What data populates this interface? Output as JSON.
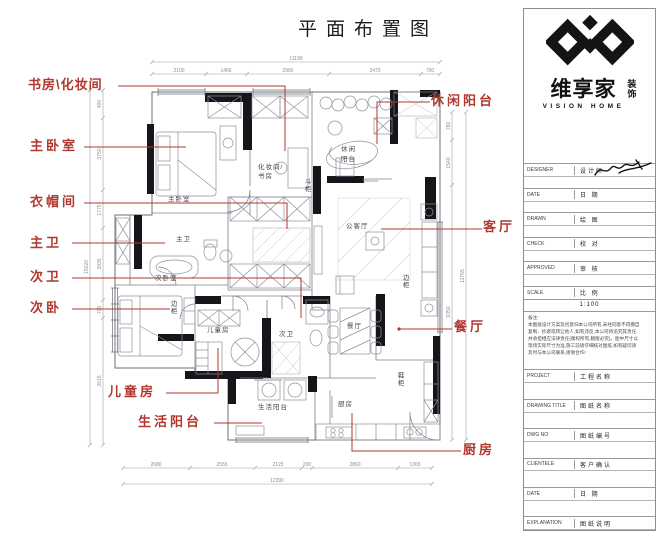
{
  "title": "平面布置图",
  "annotations": {
    "left": [
      "书房\\化妆间",
      "主卧室",
      "衣帽间",
      "主卫",
      "次卫",
      "次卧",
      "儿童房",
      "生活阳台"
    ],
    "right": [
      "休闲阳台",
      "客厅",
      "餐厅",
      "厨房"
    ]
  },
  "rooms": {
    "master_bedroom": "主卧室",
    "study_line1": "化妆间/",
    "study_line2": "书房",
    "chest": "斗柜",
    "leisure_line1": "休闲",
    "leisure_line2": "阳台",
    "living": "公客厅",
    "master_bath": "主卫",
    "second_bedroom": "次卧室",
    "side_cabinet_bedroom": "边柜",
    "kids_room": "儿童房",
    "second_bath": "次卫",
    "laundry_balcony": "生活阳台",
    "dining": "餐厅",
    "shoe_cabinet": "鞋柜",
    "kitchen": "厨房",
    "side_cabinet_living": "边柜"
  },
  "dims": {
    "top": {
      "total": "11190",
      "segments": [
        "2100",
        "1466",
        "2965",
        "3470",
        "700"
      ]
    },
    "bottom": {
      "total": "12390",
      "segments": [
        "2680",
        "2555",
        "2125",
        "200",
        "2860",
        "1365"
      ]
    },
    "left": {
      "total": "15020",
      "segments": [
        "400",
        "3750",
        "1775",
        "3935",
        "705",
        "2615"
      ]
    },
    "right": {
      "total": "11755",
      "segments": [
        "780",
        "1540",
        "9350"
      ]
    }
  },
  "brand": {
    "name_cn": "维享家",
    "suffix_char1": "装",
    "suffix_char2": "饰",
    "name_en": "VISION HOME"
  },
  "titleblock": {
    "scale_value": "1:100",
    "notes_title": "备注:",
    "notes_lines": [
      "本图纸设计方案及创意归本公司所有,未经同意不得擅自",
      "复制、抄袭或转让他人,如有违反,本公司将追究其责任,",
      "并承担相应法律责任(版权所有,翻版必究)。图中尺寸以",
      "现场实际尺寸为准,施工前请仔细核对图纸,如有疑问请",
      "及时与本公司联系,谢谢合作!"
    ],
    "rows": [
      {
        "en": "DESIGNER",
        "cn": "设计师"
      },
      {
        "en": "DATE",
        "cn": "日 期"
      },
      {
        "en": "DRAWN",
        "cn": "绘 图"
      },
      {
        "en": "CHECK",
        "cn": "校 对"
      },
      {
        "en": "APPROVED",
        "cn": "审 核"
      },
      {
        "en": "SCALE",
        "cn": "比 例"
      },
      {
        "en": "PROJECT",
        "cn": "工程名称"
      },
      {
        "en": "DRAWING TITLE",
        "cn": "图纸名称"
      },
      {
        "en": "DWG NO",
        "cn": "图纸编号"
      },
      {
        "en": "CLIENTELE",
        "cn": "客户确认"
      },
      {
        "en": "DATE",
        "cn": "日 期"
      },
      {
        "en": "EXPLANATION",
        "cn": "图纸说明"
      }
    ]
  }
}
